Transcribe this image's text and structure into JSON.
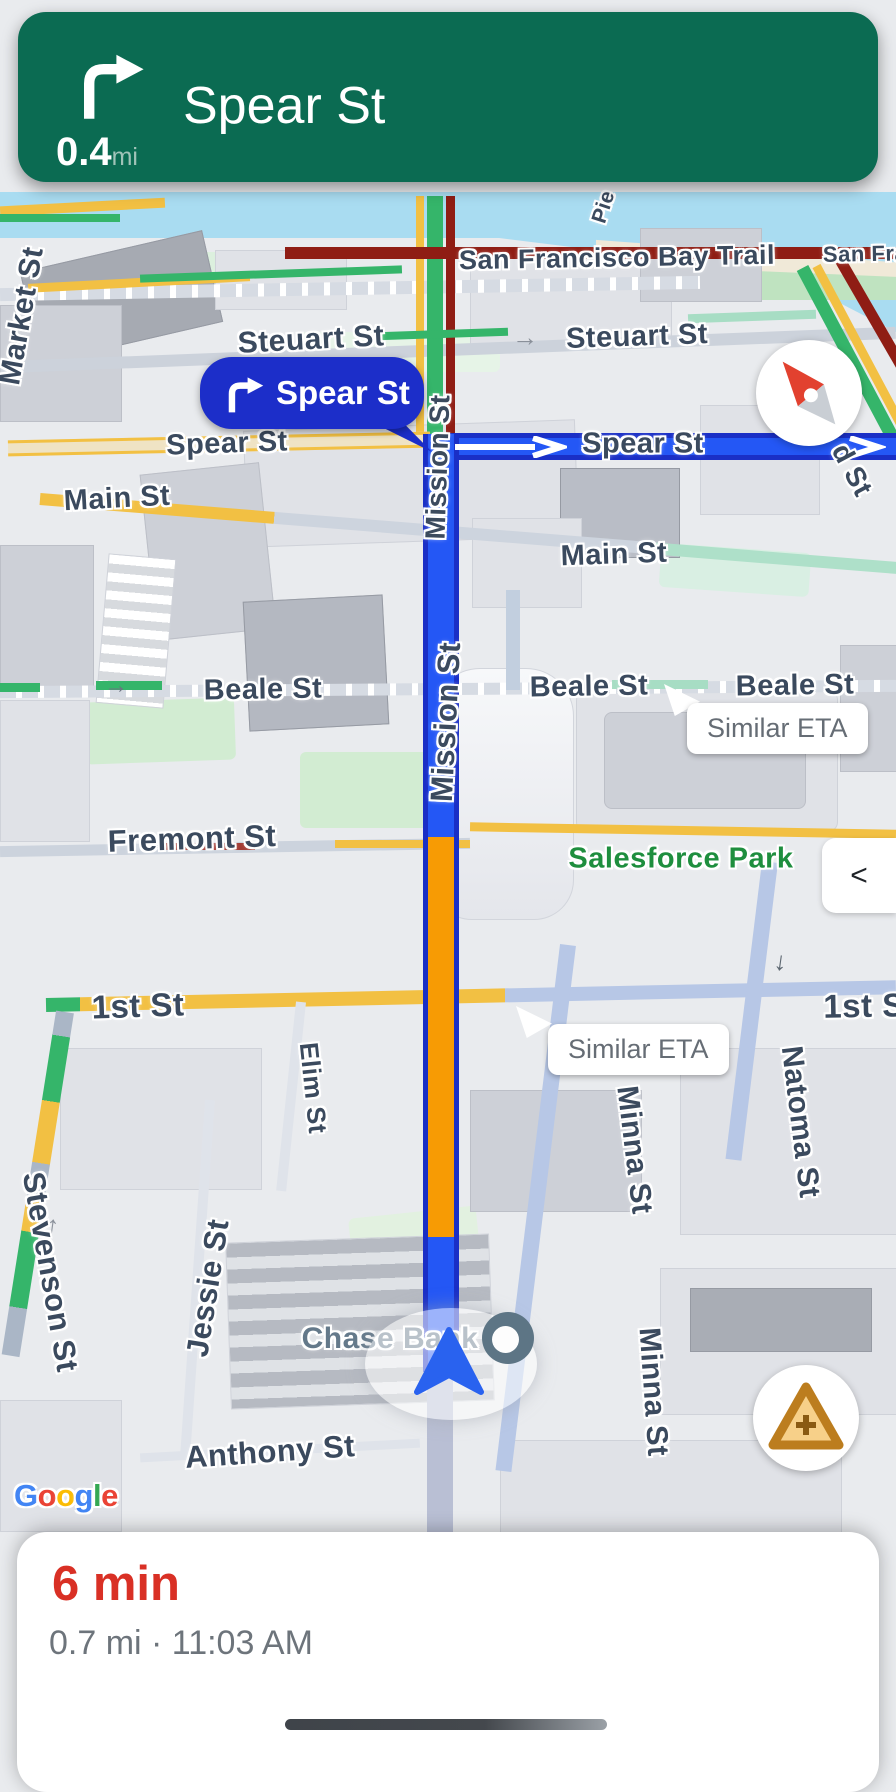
{
  "banner": {
    "maneuver": "turn-right",
    "distance": "0.4",
    "distance_unit": "mi",
    "street": "Spear St",
    "bg_color": "#0b6b52"
  },
  "nav_callout": {
    "street": "Spear St",
    "bg_color": "#1c2ec9"
  },
  "eta_bubbles": [
    {
      "text": "Similar ETA"
    },
    {
      "text": "Similar ETA"
    }
  ],
  "buttons": {
    "collapse": "<",
    "report_plus": "+"
  },
  "bottom_sheet": {
    "eta": "6 min",
    "detail": "0.7 mi · 11:03 AM",
    "eta_color": "#d93025",
    "detail_color": "#6d747b"
  },
  "attribution": {
    "brand": "Google",
    "letters": [
      {
        "ch": "G",
        "color": "#4285F4"
      },
      {
        "ch": "o",
        "color": "#EA4335"
      },
      {
        "ch": "o",
        "color": "#FBBC05"
      },
      {
        "ch": "g",
        "color": "#4285F4"
      },
      {
        "ch": "l",
        "color": "#34A853"
      },
      {
        "ch": "e",
        "color": "#EA4335"
      }
    ]
  },
  "colors": {
    "route_blue": "#2457f5",
    "route_border": "#1a2fc6",
    "traffic_orange": "#f79b04",
    "traffic_dark_red": "#8f1d14",
    "traffic_yellow": "#f2c043",
    "traffic_green": "#35b56a",
    "water": "#a9dcf1",
    "street_label": "#3b4a5e",
    "park_label": "#1e8e3e"
  },
  "map": {
    "labels": [
      {
        "id": "san-francisco-bay-trail",
        "text": "San Francisco Bay Trail",
        "x": 617,
        "y": 258,
        "rot": -1,
        "size": 27
      },
      {
        "id": "san-fran",
        "text": "San Fran",
        "x": 872,
        "y": 254,
        "rot": -1,
        "size": 22
      },
      {
        "id": "pier",
        "text": "Pie",
        "x": 604,
        "y": 207,
        "rot": -72,
        "size": 21
      },
      {
        "id": "market-st",
        "text": "Market St",
        "x": 22,
        "y": 316,
        "rot": -80,
        "size": 30
      },
      {
        "id": "steuart-st-left",
        "text": "Steuart St",
        "x": 311,
        "y": 340,
        "rot": -3,
        "size": 30
      },
      {
        "id": "steuart-st-right",
        "text": "Steuart St",
        "x": 637,
        "y": 337,
        "rot": -2,
        "size": 29
      },
      {
        "id": "spear-st-left",
        "text": "Spear St",
        "x": 227,
        "y": 444,
        "rot": -2,
        "size": 29
      },
      {
        "id": "spear-st-right",
        "text": "Spear St",
        "x": 643,
        "y": 444,
        "rot": 0,
        "size": 29
      },
      {
        "id": "main-st-left",
        "text": "Main St",
        "x": 117,
        "y": 499,
        "rot": -3,
        "size": 29
      },
      {
        "id": "main-st-right",
        "text": "Main St",
        "x": 614,
        "y": 555,
        "rot": -2,
        "size": 29
      },
      {
        "id": "beale-st-left",
        "text": "Beale St",
        "x": 263,
        "y": 690,
        "rot": -1,
        "size": 29
      },
      {
        "id": "beale-st-mid",
        "text": "Beale St",
        "x": 589,
        "y": 687,
        "rot": -1,
        "size": 29
      },
      {
        "id": "beale-st-right",
        "text": "Beale St",
        "x": 795,
        "y": 686,
        "rot": -1,
        "size": 29
      },
      {
        "id": "fremont-st",
        "text": "Fremont St",
        "x": 192,
        "y": 839,
        "rot": -2,
        "size": 31
      },
      {
        "id": "salesforce-park",
        "text": "Salesforce Park",
        "x": 681,
        "y": 859,
        "rot": 0,
        "size": 29,
        "type": "park"
      },
      {
        "id": "first-st-left",
        "text": "1st St",
        "x": 138,
        "y": 1006,
        "rot": -2,
        "size": 33
      },
      {
        "id": "first-st-right",
        "text": "1st S",
        "x": 864,
        "y": 1006,
        "rot": -1,
        "size": 33
      },
      {
        "id": "d-st",
        "text": "d St",
        "x": 852,
        "y": 470,
        "rot": 62,
        "size": 28
      },
      {
        "id": "mission-st-upper",
        "text": "Mission St",
        "x": 438,
        "y": 467,
        "rot": -88,
        "size": 28
      },
      {
        "id": "mission-st-lower",
        "text": "Mission St",
        "x": 446,
        "y": 722,
        "rot": -87,
        "size": 31
      },
      {
        "id": "natoma-st",
        "text": "Natoma St",
        "x": 800,
        "y": 1122,
        "rot": 83,
        "size": 30
      },
      {
        "id": "minna-st-upper",
        "text": "Minna St",
        "x": 634,
        "y": 1150,
        "rot": 83,
        "size": 30
      },
      {
        "id": "minna-st-lower",
        "text": "Minna St",
        "x": 653,
        "y": 1392,
        "rot": 86,
        "size": 30
      },
      {
        "id": "elim-st",
        "text": "Elim St",
        "x": 313,
        "y": 1088,
        "rot": 84,
        "size": 26
      },
      {
        "id": "jessie-st",
        "text": "Jessie St",
        "x": 208,
        "y": 1288,
        "rot": -81,
        "size": 31
      },
      {
        "id": "stevenson-st",
        "text": "Stevenson St",
        "x": 50,
        "y": 1272,
        "rot": 80,
        "size": 31
      },
      {
        "id": "anthony-st",
        "text": "Anthony St",
        "x": 270,
        "y": 1452,
        "rot": -4,
        "size": 31
      },
      {
        "id": "chase-bank",
        "text": "Chase Bank",
        "x": 390,
        "y": 1339,
        "rot": 0,
        "size": 30,
        "type": "poi"
      }
    ]
  }
}
